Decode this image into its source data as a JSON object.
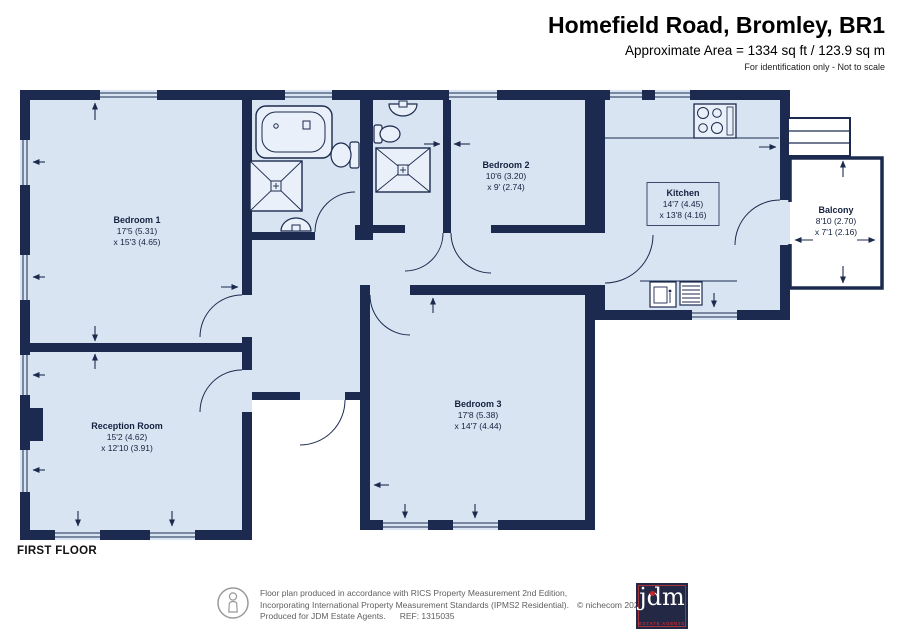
{
  "header": {
    "title": "Homefield Road, Bromley, BR1",
    "area_line": "Approximate Area = 1334 sq ft / 123.9 sq m",
    "note": "For identification only - Not to scale"
  },
  "floor_label": "FIRST FLOOR",
  "rooms": [
    {
      "name": "Bedroom 1",
      "dim1": "17'5 (5.31)",
      "dim2": "x 15'3 (4.65)"
    },
    {
      "name": "Reception Room",
      "dim1": "15'2 (4.62)",
      "dim2": "x 12'10 (3.91)"
    },
    {
      "name": "Bedroom 2",
      "dim1": "10'6 (3.20)",
      "dim2": "x 9' (2.74)"
    },
    {
      "name": "Bedroom 3",
      "dim1": "17'8 (5.38)",
      "dim2": "x 14'7 (4.44)"
    },
    {
      "name": "Kitchen",
      "dim1": "14'7 (4.45)",
      "dim2": "x 13'8 (4.16)"
    },
    {
      "name": "Balcony",
      "dim1": "8'10 (2.70)",
      "dim2": "x 7'1 (2.16)"
    }
  ],
  "footer": {
    "line1": "Floor plan produced in accordance with RICS Property Measurement 2nd Edition,",
    "line2": "Incorporating International Property Measurement Standards (IPMS2 Residential).",
    "copyright": "© nichecom 2025.",
    "line3": "Produced for JDM Estate Agents.",
    "ref": "REF: 1315035",
    "logo_text": "jdm",
    "logo_sub": "ESTATE AGENTS"
  },
  "colors": {
    "wall": "#1b2a4e",
    "room_fill": "#d9e4f2",
    "accent_red": "#c1272d"
  }
}
